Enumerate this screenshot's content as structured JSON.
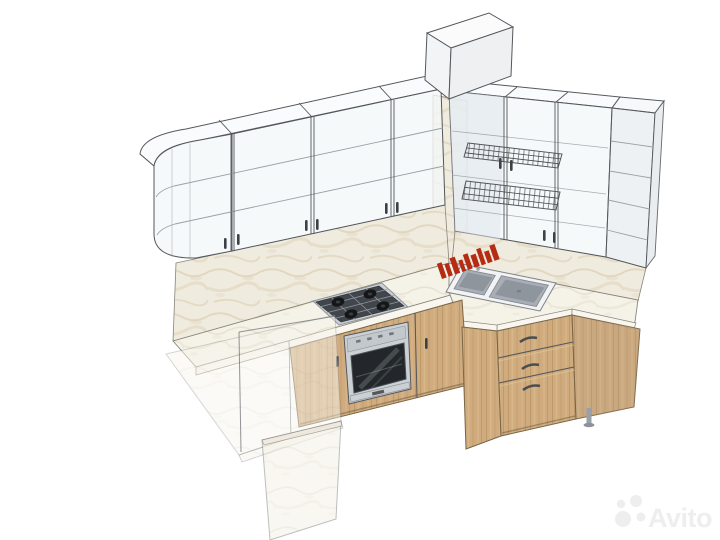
{
  "scene": {
    "subject": "L-shaped kitchen 3D design sketch",
    "style": "wireframe-shaded CAD render on white background"
  },
  "watermark": {
    "label": "Avito"
  },
  "parts": [
    "vent-duct-box",
    "wall-cabinets-left-glass",
    "curved-corner-cabinet",
    "wall-cabinets-right-glass",
    "wire-dish-racks",
    "open-shelf-end-unit",
    "marble-backsplash",
    "stone-countertop",
    "gas-hob-4-burner",
    "built-in-oven",
    "double-bowl-sink",
    "red-brand-stamp",
    "three-drawer-base-unit",
    "wood-base-cabinets",
    "ghost-peninsula-counter",
    "adjustable-foot",
    "avito-watermark"
  ],
  "palette": {
    "background": "#ffffff",
    "outline": "#54575b",
    "lineSoft": "#9aa0a6",
    "glass": "rgba(244,247,249,0.78)",
    "glassShade": "rgba(222,229,235,0.55)",
    "marbleBase": "#f0ebdf",
    "marbleVein": "#dcd1b6",
    "counterBase": "#f5f2e8",
    "counterVein": "#e5dfcd",
    "counterEdge": "#f8f6ef",
    "wood": "#cfab7e",
    "woodDark": "#b08a58",
    "woodLight": "#e0c294",
    "steel": "#cbd0d5",
    "steelDark": "#8e9499",
    "ovenGlass": "#23272b",
    "burner": "#141617",
    "sink": "#a9aeb6",
    "sinkDeep": "#8f959d",
    "stampRed": "#b52c12",
    "ghostLine": "rgba(90,93,98,0.65)",
    "watermarkColor": "#eeeeee"
  }
}
